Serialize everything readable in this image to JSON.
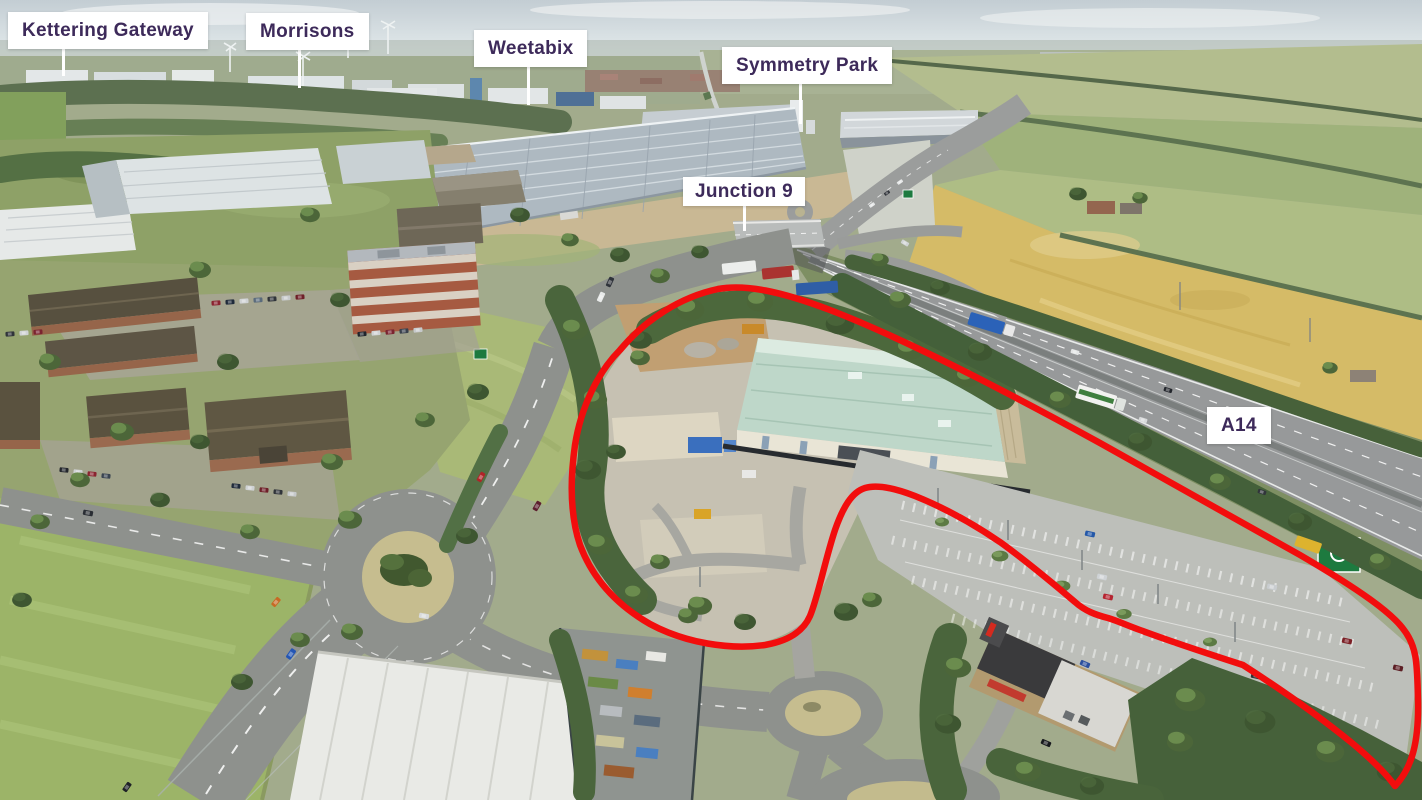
{
  "labels": [
    {
      "id": "kettering-gateway",
      "text": "Kettering Gateway"
    },
    {
      "id": "morrisons",
      "text": "Morrisons"
    },
    {
      "id": "weetabix",
      "text": "Weetabix"
    },
    {
      "id": "symmetry-park",
      "text": "Symmetry Park"
    },
    {
      "id": "junction-9",
      "text": "Junction 9"
    },
    {
      "id": "a14",
      "text": "A14"
    }
  ],
  "colors": {
    "label_background": "#ffffff",
    "label_text": "#3d2a5a",
    "leader_line": "#ffffff",
    "site_boundary": "#f20d0d"
  }
}
